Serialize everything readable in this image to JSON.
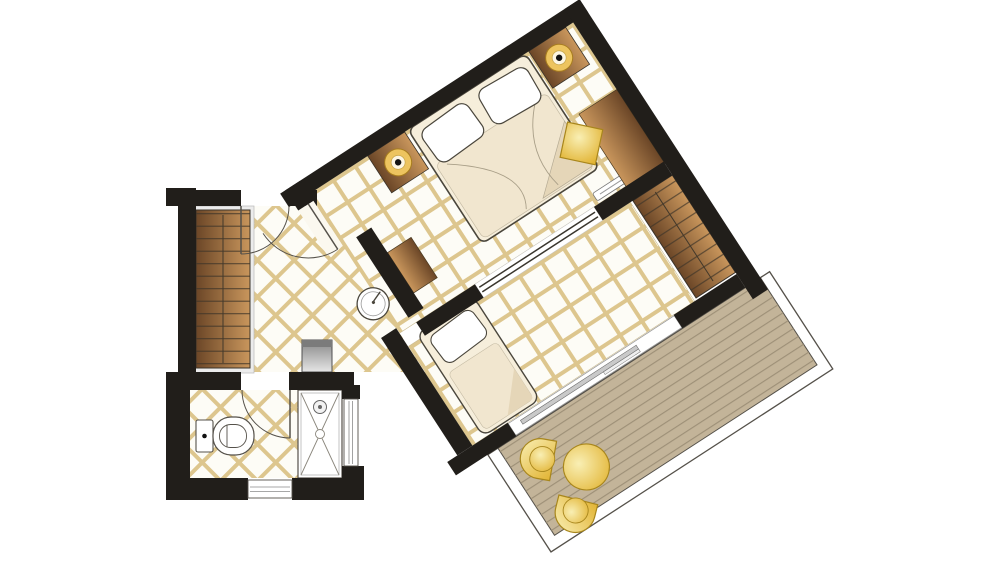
{
  "title": "Hotel guest room floor plan",
  "plan": {
    "orientation_deg": -33,
    "rooms": [
      {
        "name": "Main Bedroom",
        "furniture": [
          "double-bed",
          "pillow",
          "pillow",
          "nightstand-with-lamp",
          "nightstand-with-lamp",
          "desk",
          "desk-chair",
          "vanity-console",
          "entry-door"
        ]
      },
      {
        "name": "Second Bedroom",
        "furniture": [
          "single-bed",
          "built-in-wardrobe",
          "sliding-partition",
          "sliding-glass-door"
        ]
      },
      {
        "name": "Entrance Hall",
        "furniture": [
          "built-in-wardrobe",
          "minibar",
          "round-mirror",
          "entrance-door"
        ]
      },
      {
        "name": "Bathroom",
        "furniture": [
          "toilet",
          "shower",
          "bottom-window",
          "side-window",
          "door"
        ]
      },
      {
        "name": "Balcony",
        "furniture": [
          "wood-decking",
          "railing",
          "round-table",
          "chair",
          "chair"
        ]
      }
    ]
  },
  "colors": {
    "canvas": "#ffffff",
    "wall": "#211e1a",
    "tile_bg": "#fdfcf6",
    "tile_line": "#ddc68e",
    "deck": "#c3b499",
    "deck_line": "#9c8e76",
    "wood_dark": "#6b4627",
    "wood_light": "#c9965c",
    "rung": "#3f3428",
    "bedding": "#f6eedb",
    "bedding_shade": "#f1e6cf",
    "bedding_fold": "#e5d6b8",
    "gold_light": "#f9efb4",
    "gold_dark": "#e2b434",
    "gold_edge": "#a8861c",
    "lamp_gold": "#edc45f",
    "outline": "#4a463c",
    "metal_dark": "#858585",
    "metal_light": "#e6e6e6",
    "glass_bar": "#c9c9c9",
    "door_arc": "#55514a",
    "backing": "#ececec"
  }
}
